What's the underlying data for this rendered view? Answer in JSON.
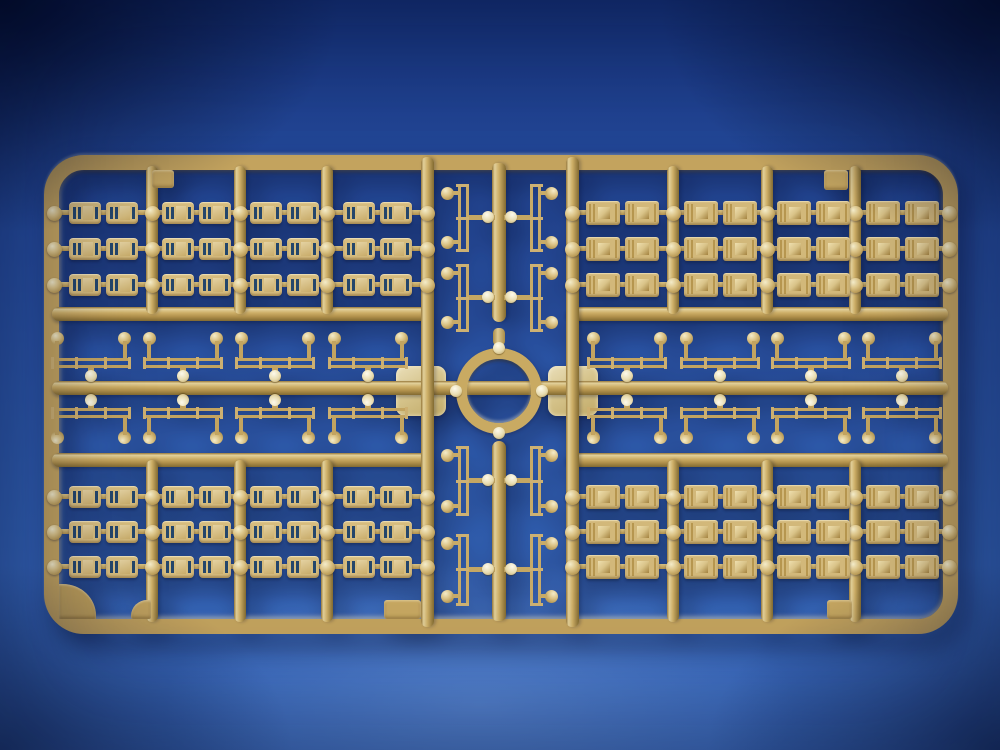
{
  "scene": {
    "subject": "tan plastic model kit sprue photographed on blue background",
    "palette": {
      "background_blue_top": "#16337b",
      "background_blue_mid": "#2c56aa",
      "background_blue_bottom": "#3f70c4",
      "vignette_dark": "#01061c",
      "plastic_tan": "#c8a961",
      "plastic_highlight": "#e2d09a",
      "plastic_shadow": "#826a31",
      "part_face_tan": "#d6bc7e",
      "hatch_slit_dark": "#24466b",
      "gate_cream": "#ece2bd"
    },
    "frame": {
      "x": 44,
      "y": 155,
      "w": 914,
      "h": 479,
      "border": 15,
      "radius": 40
    },
    "runners": {
      "horizontal": [
        {
          "x": 52,
          "y": 307,
          "w": 378
        },
        {
          "x": 566,
          "y": 307,
          "w": 382
        },
        {
          "x": 52,
          "y": 381,
          "w": 896
        },
        {
          "x": 52,
          "y": 453,
          "w": 378
        },
        {
          "x": 566,
          "y": 453,
          "w": 382
        }
      ],
      "vertical_full": [
        {
          "x": 421,
          "y": 157,
          "h": 470
        },
        {
          "x": 566,
          "y": 157,
          "h": 470
        }
      ],
      "vertical_quadrant": [
        {
          "x": 146,
          "y": 166,
          "h": 148
        },
        {
          "x": 234,
          "y": 166,
          "h": 148
        },
        {
          "x": 321,
          "y": 166,
          "h": 148
        },
        {
          "x": 667,
          "y": 166,
          "h": 148
        },
        {
          "x": 761,
          "y": 166,
          "h": 148
        },
        {
          "x": 849,
          "y": 166,
          "h": 148
        },
        {
          "x": 146,
          "y": 460,
          "h": 162
        },
        {
          "x": 234,
          "y": 460,
          "h": 162
        },
        {
          "x": 321,
          "y": 460,
          "h": 162
        },
        {
          "x": 667,
          "y": 460,
          "h": 162
        },
        {
          "x": 761,
          "y": 460,
          "h": 162
        },
        {
          "x": 849,
          "y": 460,
          "h": 162
        }
      ],
      "center_segments": [
        {
          "x": 492,
          "y": 163,
          "h": 159,
          "round": "bottom"
        },
        {
          "x": 492,
          "y": 441,
          "h": 180,
          "round": "top"
        }
      ],
      "ring_top_stub": {
        "x": 493,
        "y": 328,
        "w": 12,
        "h": 18
      }
    },
    "quadrants": [
      {
        "name": "top-left",
        "hatch": "A",
        "runner_centers": [
          54,
          152,
          240,
          327,
          427
        ],
        "row_tops": [
          202,
          238,
          274
        ]
      },
      {
        "name": "top-right",
        "hatch": "B",
        "runner_centers": [
          572,
          673,
          767,
          855,
          949
        ],
        "row_tops": [
          202,
          238,
          274
        ]
      },
      {
        "name": "bottom-left",
        "hatch": "A",
        "runner_centers": [
          54,
          152,
          240,
          327,
          427
        ],
        "row_tops": [
          486,
          521,
          556
        ]
      },
      {
        "name": "bottom-right",
        "hatch": "B",
        "runner_centers": [
          572,
          673,
          767,
          855,
          949
        ],
        "row_tops": [
          486,
          521,
          556
        ]
      }
    ],
    "davits": {
      "part_w": 84,
      "part_h": 50,
      "rows": [
        {
          "y": 331,
          "dir": "up",
          "xs": [
            49,
            141,
            233,
            326,
            585,
            678,
            769,
            860
          ]
        },
        {
          "y": 395,
          "dir": "down",
          "xs": [
            49,
            141,
            233,
            326,
            585,
            678,
            769,
            860
          ]
        }
      ]
    },
    "ladders": {
      "part_w": 54,
      "groups": [
        {
          "rows": [
            {
              "y": 182,
              "h": 72
            },
            {
              "y": 262,
              "h": 72
            }
          ],
          "left_x": 441,
          "right_x": 504
        },
        {
          "rows": [
            {
              "y": 444,
              "h": 74
            },
            {
              "y": 532,
              "h": 76
            }
          ],
          "left_x": 441,
          "right_x": 504
        }
      ]
    },
    "ring": {
      "cx": 499,
      "cy": 391,
      "outer_d": 86,
      "thickness": 11,
      "nubs": [
        {
          "x": 493,
          "y": 342
        },
        {
          "x": 493,
          "y": 427
        },
        {
          "x": 450,
          "y": 385
        },
        {
          "x": 536,
          "y": 385
        }
      ]
    },
    "pads": [
      {
        "x": 396,
        "y": 366,
        "w": 50,
        "h": 50
      },
      {
        "x": 548,
        "y": 366,
        "w": 50,
        "h": 50
      }
    ],
    "tabs": [
      {
        "x": 152,
        "y": 170,
        "w": 22,
        "h": 18,
        "kind": "square"
      },
      {
        "x": 824,
        "y": 170,
        "w": 24,
        "h": 20,
        "kind": "square"
      },
      {
        "x": 59,
        "y": 584,
        "w": 37,
        "h": 35,
        "kind": "corner-gusset"
      },
      {
        "x": 131,
        "y": 600,
        "w": 20,
        "h": 19,
        "kind": "wedge"
      },
      {
        "x": 384,
        "y": 600,
        "w": 37,
        "h": 19,
        "kind": "square"
      },
      {
        "x": 827,
        "y": 600,
        "w": 25,
        "h": 19,
        "kind": "square"
      }
    ]
  }
}
